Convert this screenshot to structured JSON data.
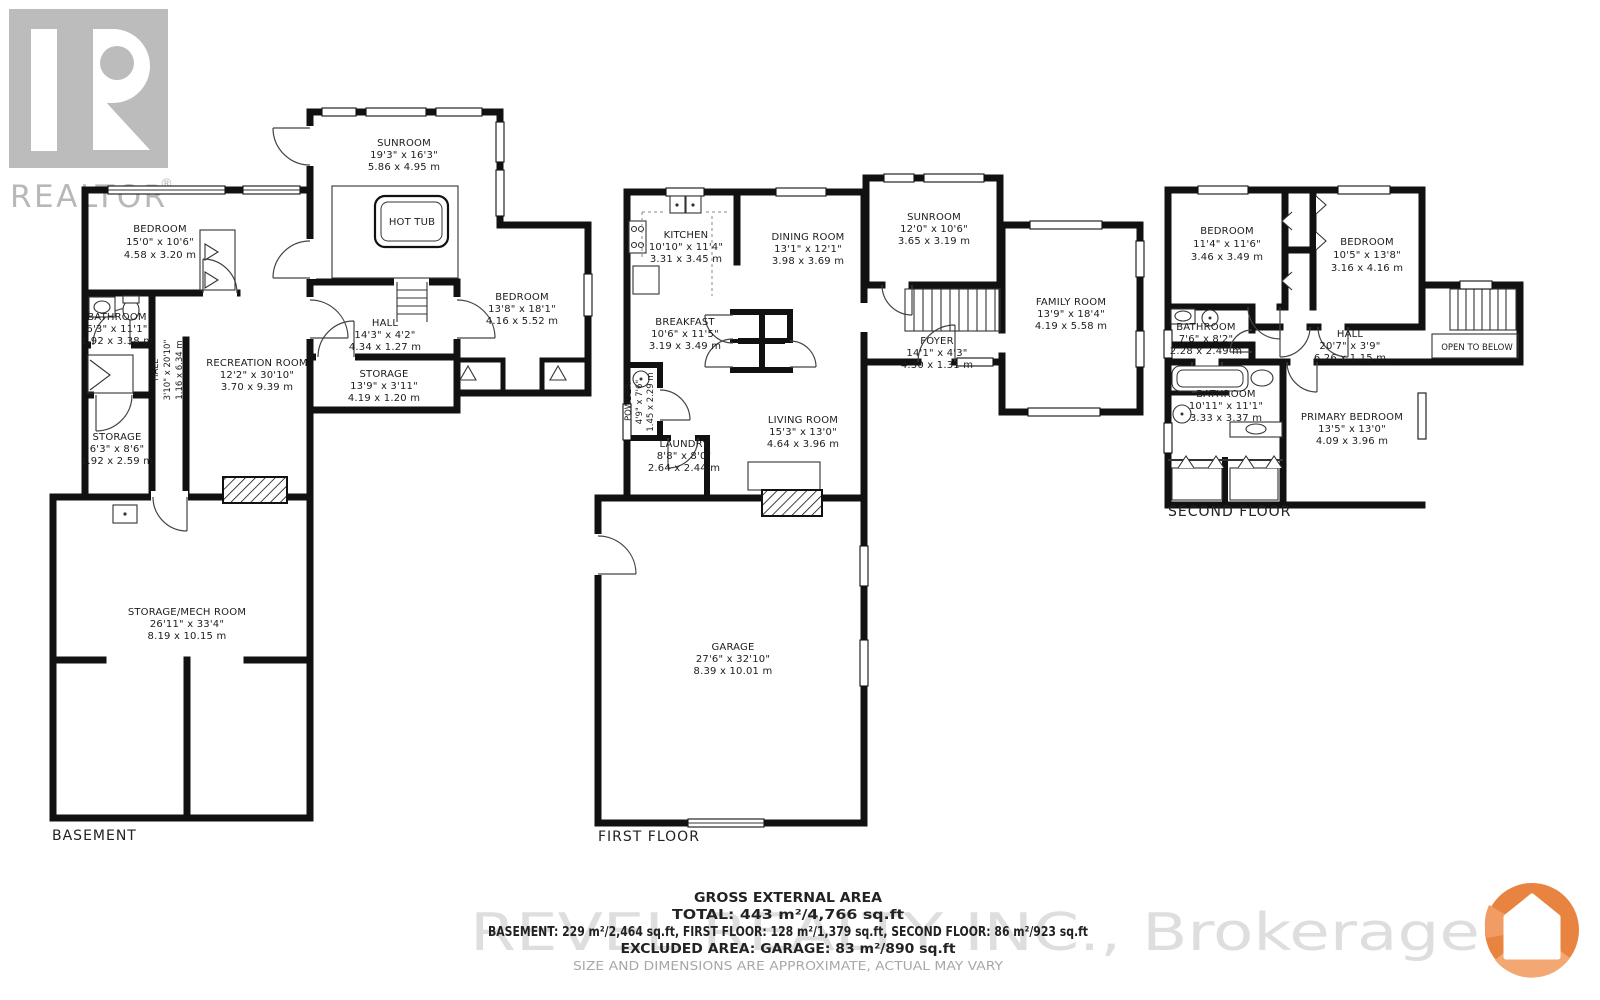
{
  "branding": {
    "realtor_wordmark": "REALTOR",
    "registered_mark": "®",
    "watermark": "REVEL REALTY INC., Brokerage"
  },
  "colors": {
    "wall": "#111111",
    "logo_gray": "#bcbcbc",
    "watermark_gray": "#dedede",
    "brand_orange": "#E98440"
  },
  "footer": {
    "title": "GROSS EXTERNAL AREA",
    "total": "TOTAL: 443 m²/4,766 sq.ft",
    "breakdown": "BASEMENT: 229 m²/2,464 sq.ft, FIRST FLOOR: 128 m²/1,379 sq.ft, SECOND FLOOR: 86 m²/923 sq.ft",
    "excluded": "EXCLUDED AREA: GARAGE: 83 m²/890 sq.ft",
    "disclaimer": "SIZE AND DIMENSIONS ARE APPROXIMATE, ACTUAL MAY VARY"
  },
  "floors": {
    "basement": {
      "label": "BASEMENT",
      "rooms": {
        "bedroom_left": {
          "name": "BEDROOM",
          "imperial": "15'0\" x 10'6\"",
          "metric": "4.58 x 3.20 m"
        },
        "bathroom": {
          "name": "BATHROOM",
          "imperial": "6'3\" x 11'1\"",
          "metric": "1.92 x 3.38 m"
        },
        "hall_vertical": {
          "name": "HALL",
          "imperial": "3'10\" x 20'10\"",
          "metric": "1.16 x 6.34 m"
        },
        "recreation_room": {
          "name": "RECREATION ROOM",
          "imperial": "12'2\" x 30'10\"",
          "metric": "3.70 x 9.39 m"
        },
        "sunroom": {
          "name": "SUNROOM",
          "imperial": "19'3\" x 16'3\"",
          "metric": "5.86 x 4.95 m"
        },
        "hot_tub": {
          "name": "HOT TUB"
        },
        "bedroom_right": {
          "name": "BEDROOM",
          "imperial": "13'8\" x 18'1\"",
          "metric": "4.16 x 5.52 m"
        },
        "hall": {
          "name": "HALL",
          "imperial": "14'3\" x 4'2\"",
          "metric": "4.34 x 1.27 m"
        },
        "storage_long": {
          "name": "STORAGE",
          "imperial": "13'9\" x 3'11\"",
          "metric": "4.19 x 1.20 m"
        },
        "storage_small": {
          "name": "STORAGE",
          "imperial": "6'3\" x 8'6\"",
          "metric": "1.92 x 2.59 m"
        },
        "storage_mech": {
          "name": "STORAGE/MECH ROOM",
          "imperial": "26'11\" x 33'4\"",
          "metric": "8.19 x 10.15 m"
        }
      }
    },
    "first_floor": {
      "label": "FIRST FLOOR",
      "rooms": {
        "kitchen": {
          "name": "KITCHEN",
          "imperial": "10'10\" x 11'4\"",
          "metric": "3.31 x 3.45 m"
        },
        "dining_room": {
          "name": "DINING ROOM",
          "imperial": "13'1\" x 12'1\"",
          "metric": "3.98 x 3.69 m"
        },
        "breakfast": {
          "name": "BREAKFAST",
          "imperial": "10'6\" x 11'5\"",
          "metric": "3.19 x 3.49 m"
        },
        "powder": {
          "name": "POWDER",
          "imperial": "4'9\" x 7'6\"",
          "metric": "1.45 x 2.29 m"
        },
        "laundry": {
          "name": "LAUNDRY",
          "imperial": "8'8\" x 8'0\"",
          "metric": "2.64 x 2.44 m"
        },
        "living_room": {
          "name": "LIVING ROOM",
          "imperial": "15'3\" x 13'0\"",
          "metric": "4.64 x 3.96 m"
        },
        "sunroom": {
          "name": "SUNROOM",
          "imperial": "12'0\" x 10'6\"",
          "metric": "3.65 x 3.19 m"
        },
        "foyer": {
          "name": "FOYER",
          "imperial": "14'1\" x 4'3\"",
          "metric": "4.30 x 1.31 m"
        },
        "family_room": {
          "name": "FAMILY ROOM",
          "imperial": "13'9\" x 18'4\"",
          "metric": "4.19 x 5.58 m"
        },
        "garage": {
          "name": "GARAGE",
          "imperial": "27'6\" x 32'10\"",
          "metric": "8.39 x 10.01 m"
        }
      }
    },
    "second_floor": {
      "label": "SECOND FLOOR",
      "rooms": {
        "bedroom_left": {
          "name": "BEDROOM",
          "imperial": "11'4\" x 11'6\"",
          "metric": "3.46 x 3.49 m"
        },
        "bedroom_right": {
          "name": "BEDROOM",
          "imperial": "10'5\" x 13'8\"",
          "metric": "3.16 x 4.16 m"
        },
        "bathroom_small": {
          "name": "BATHROOM",
          "imperial": "7'6\" x 8'2\"",
          "metric": "2.28 x 2.49 m"
        },
        "hall": {
          "name": "HALL",
          "imperial": "20'7\" x 3'9\"",
          "metric": "6.26 x 1.15 m"
        },
        "open_to_below": {
          "name": "OPEN TO BELOW"
        },
        "bathroom_large": {
          "name": "BATHROOM",
          "imperial": "10'11\" x 11'1\"",
          "metric": "3.33 x 3.37 m"
        },
        "primary_bedroom": {
          "name": "PRIMARY BEDROOM",
          "imperial": "13'5\" x 13'0\"",
          "metric": "4.09 x 3.96 m"
        }
      }
    }
  }
}
